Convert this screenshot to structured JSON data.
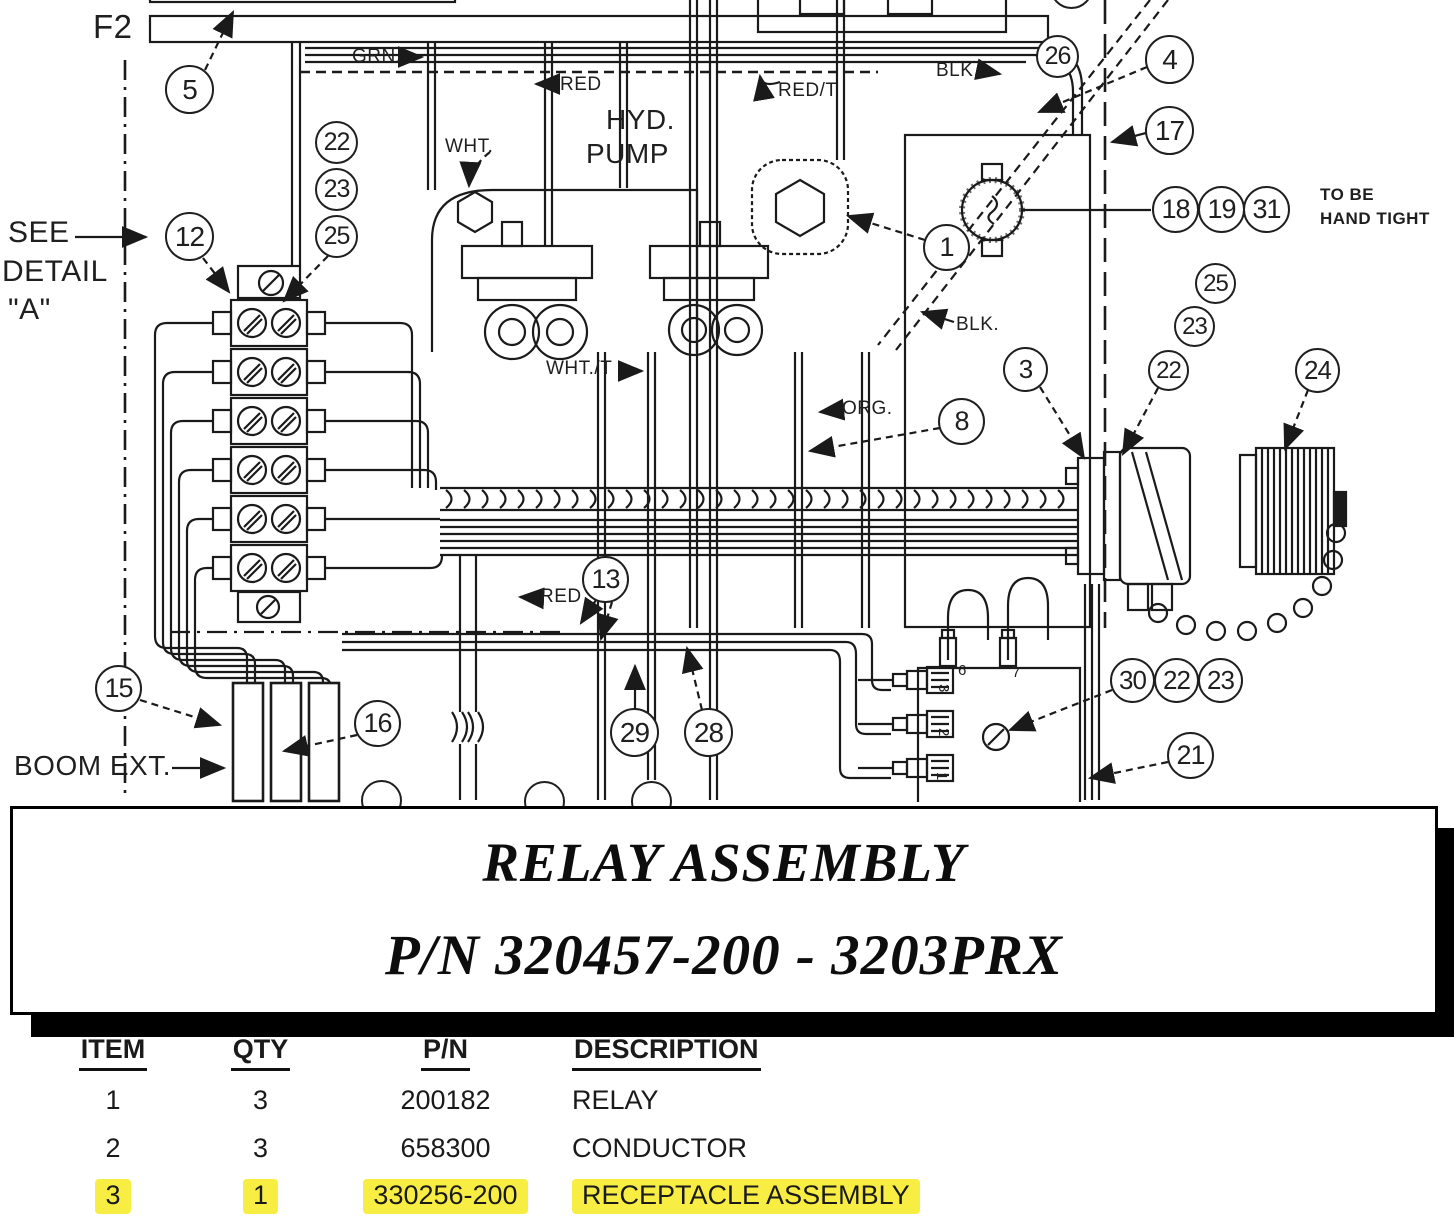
{
  "page": {
    "background": "#ffffff",
    "line_color": "#1a1a1a"
  },
  "diagram": {
    "balloons": [
      {
        "n": "5",
        "x": 190,
        "y": 90,
        "r": 25
      },
      {
        "n": "22",
        "x": 337,
        "y": 143,
        "r": 22
      },
      {
        "n": "23",
        "x": 337,
        "y": 190,
        "r": 22
      },
      {
        "n": "25",
        "x": 337,
        "y": 237,
        "r": 22
      },
      {
        "n": "12",
        "x": 190,
        "y": 237,
        "r": 25
      },
      {
        "n": "2",
        "x": 1072,
        "y": -12,
        "r": 22
      },
      {
        "n": "26",
        "x": 1058,
        "y": 57,
        "r": 22
      },
      {
        "n": "4",
        "x": 1170,
        "y": 60,
        "r": 25
      },
      {
        "n": "17",
        "x": 1170,
        "y": 131,
        "r": 25
      },
      {
        "n": "18",
        "x": 1176,
        "y": 210,
        "r": 24
      },
      {
        "n": "19",
        "x": 1222,
        "y": 210,
        "r": 24
      },
      {
        "n": "31",
        "x": 1267,
        "y": 210,
        "r": 24
      },
      {
        "n": "25",
        "x": 1216,
        "y": 284,
        "r": 21
      },
      {
        "n": "23",
        "x": 1195,
        "y": 327,
        "r": 21
      },
      {
        "n": "22",
        "x": 1169,
        "y": 371,
        "r": 21
      },
      {
        "n": "3",
        "x": 1026,
        "y": 370,
        "r": 23
      },
      {
        "n": "24",
        "x": 1318,
        "y": 371,
        "r": 23
      },
      {
        "n": "1",
        "x": 947,
        "y": 248,
        "r": 24
      },
      {
        "n": "8",
        "x": 962,
        "y": 422,
        "r": 24
      },
      {
        "n": "13",
        "x": 606,
        "y": 580,
        "r": 24
      },
      {
        "n": "15",
        "x": 119,
        "y": 689,
        "r": 24
      },
      {
        "n": "16",
        "x": 378,
        "y": 724,
        "r": 24
      },
      {
        "n": "29",
        "x": 635,
        "y": 733,
        "r": 25
      },
      {
        "n": "28",
        "x": 709,
        "y": 733,
        "r": 25
      },
      {
        "n": "30",
        "x": 1133,
        "y": 681,
        "r": 23
      },
      {
        "n": "22",
        "x": 1177,
        "y": 681,
        "r": 23
      },
      {
        "n": "23",
        "x": 1221,
        "y": 681,
        "r": 23
      },
      {
        "n": "21",
        "x": 1191,
        "y": 756,
        "r": 24
      },
      {
        "n": "",
        "x": 382,
        "y": 801,
        "r": 21
      },
      {
        "n": "",
        "x": 545,
        "y": 802,
        "r": 21
      },
      {
        "n": "",
        "x": 652,
        "y": 802,
        "r": 21
      }
    ],
    "labels": [
      {
        "id": "f2",
        "text": "F2",
        "x": 93,
        "y": 8,
        "size": 33
      },
      {
        "id": "grn",
        "text": "GRN.",
        "x": 352,
        "y": 46,
        "size": 19
      },
      {
        "id": "red-top",
        "text": "RED",
        "x": 560,
        "y": 74,
        "size": 19
      },
      {
        "id": "red-t",
        "text": "RED/T",
        "x": 778,
        "y": 80,
        "size": 19
      },
      {
        "id": "blk-top",
        "text": "BLK.",
        "x": 936,
        "y": 60,
        "size": 19
      },
      {
        "id": "hyd",
        "text": "HYD.",
        "x": 606,
        "y": 104,
        "size": 28
      },
      {
        "id": "pump",
        "text": "PUMP",
        "x": 586,
        "y": 138,
        "size": 28
      },
      {
        "id": "wht",
        "text": "WHT.",
        "x": 445,
        "y": 136,
        "size": 19
      },
      {
        "id": "see",
        "text": "SEE",
        "x": 8,
        "y": 216,
        "size": 30
      },
      {
        "id": "detail",
        "text": "DETAIL",
        "x": 2,
        "y": 255,
        "size": 30
      },
      {
        "id": "detail-a",
        "text": "\"A\"",
        "x": 8,
        "y": 293,
        "size": 30
      },
      {
        "id": "wht-t",
        "text": "WHT./T",
        "x": 546,
        "y": 358,
        "size": 19
      },
      {
        "id": "blk-mid",
        "text": "BLK.",
        "x": 956,
        "y": 314,
        "size": 19
      },
      {
        "id": "org",
        "text": "ORG.",
        "x": 842,
        "y": 398,
        "size": 19
      },
      {
        "id": "to-be",
        "text": "TO BE",
        "x": 1320,
        "y": 185,
        "size": 17,
        "bold": true
      },
      {
        "id": "hand-tight",
        "text": "HAND TIGHT",
        "x": 1320,
        "y": 209,
        "size": 17,
        "bold": true
      },
      {
        "id": "red-lower",
        "text": "RED",
        "x": 540,
        "y": 586,
        "size": 19
      },
      {
        "id": "boom-ext",
        "text": "BOOM EXT.",
        "x": 14,
        "y": 750,
        "size": 28
      },
      {
        "id": "pin-6",
        "text": "6",
        "x": 958,
        "y": 662,
        "size": 15
      },
      {
        "id": "pin-7",
        "text": "7",
        "x": 1012,
        "y": 664,
        "size": 15
      },
      {
        "id": "pin-3",
        "text": "3",
        "x": 952,
        "y": 684,
        "size": 15,
        "rot": 90
      },
      {
        "id": "pin-2",
        "text": "2",
        "x": 952,
        "y": 728,
        "size": 15,
        "rot": 90
      },
      {
        "id": "pin-1",
        "text": "1",
        "x": 950,
        "y": 772,
        "size": 15,
        "rot": 90
      }
    ]
  },
  "title_block": {
    "line1": "RELAY ASSEMBLY",
    "line2": "P/N 320457-200 - 3203PRX"
  },
  "parts_table": {
    "headers": [
      "ITEM",
      "QTY",
      "P/N",
      "DESCRIPTION"
    ],
    "rows": [
      {
        "item": "1",
        "qty": "3",
        "pn": "200182",
        "description": "RELAY",
        "highlight": false
      },
      {
        "item": "2",
        "qty": "3",
        "pn": "658300",
        "description": "CONDUCTOR",
        "highlight": false
      },
      {
        "item": "3",
        "qty": "1",
        "pn": "330256-200",
        "description": "RECEPTACLE ASSEMBLY",
        "highlight": true
      }
    ],
    "highlight_color": "#f8ee43"
  }
}
